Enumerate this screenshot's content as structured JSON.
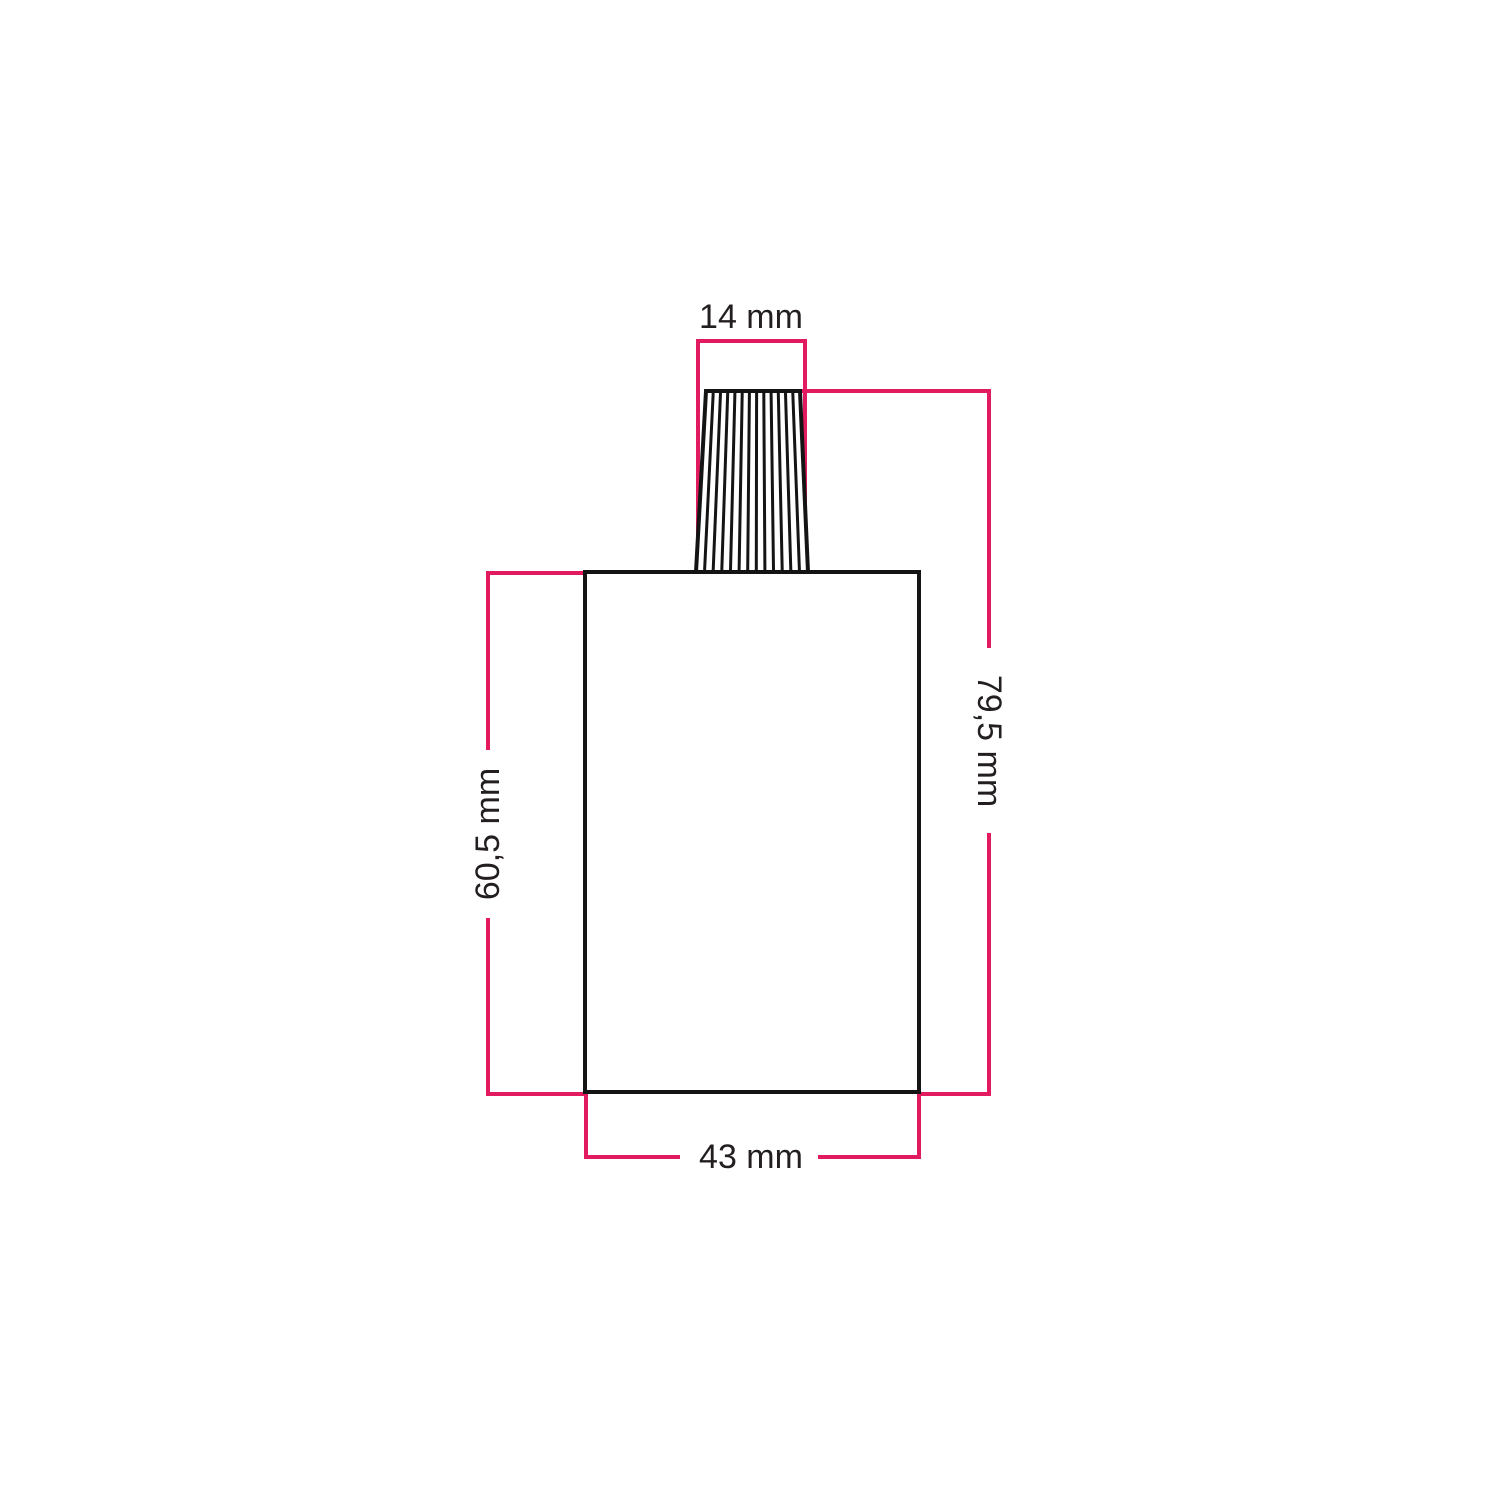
{
  "diagram": {
    "kind": "technical-dimension-drawing",
    "background_color": "#ffffff",
    "dimension_line_color": "#e21a5f",
    "drawing_line_color": "#141414",
    "text_color": "#231f20",
    "dimensions": {
      "grip_top_width": "14 mm",
      "overall_height": "79,5 mm",
      "body_height": "60,5 mm",
      "body_width": "43 mm"
    }
  }
}
